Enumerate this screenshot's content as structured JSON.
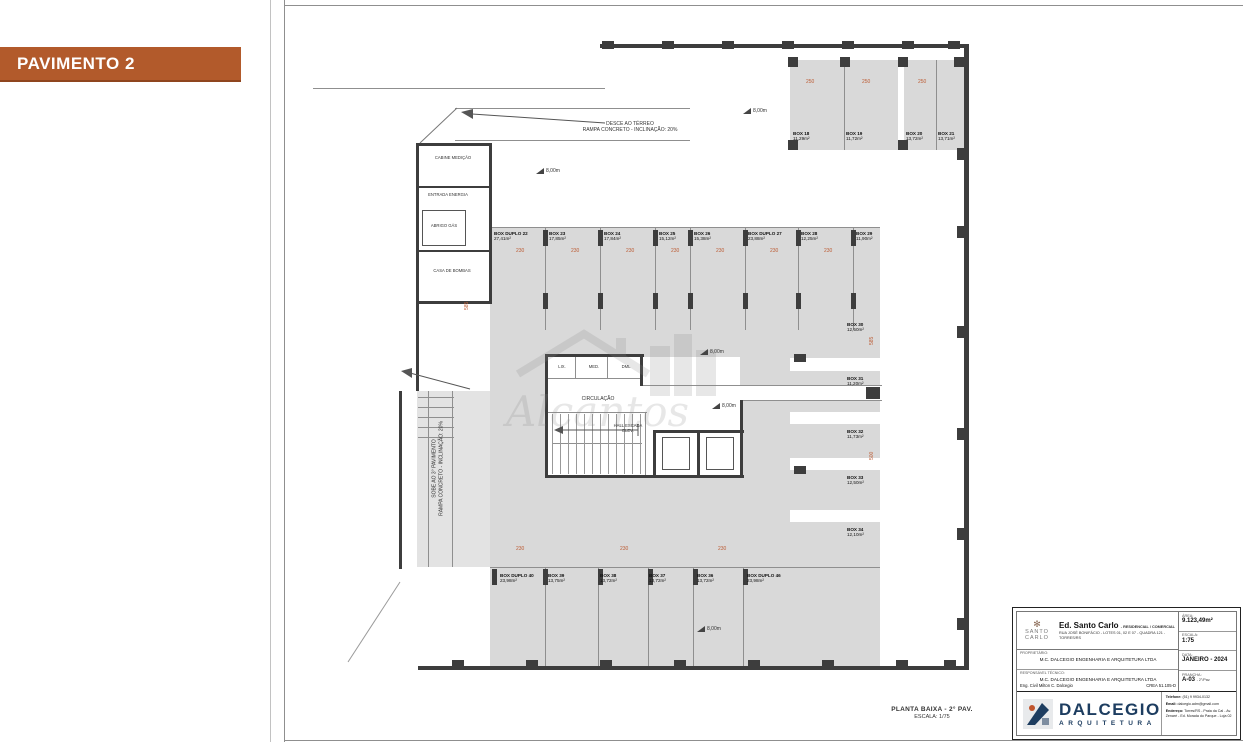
{
  "banner": {
    "label": "PAVIMENTO 2"
  },
  "plan": {
    "caption": {
      "line1": "PLANTA BAIXA - 2° PAV.",
      "line2": "ESCALA: 1/75"
    },
    "notes": {
      "ramp_down_1": "DESCE AO TÉRREO",
      "ramp_down_2": "RAMPA CONCRETO - INCLINAÇÃO: 20%",
      "ramp_up_1": "SOBE AO 3° PAVIMENTO",
      "ramp_up_2": "RAMPA CONCRETO - INCLINAÇÃO: 20%"
    },
    "core": {
      "lix": "LIX.",
      "med": "MED.",
      "dml": "DML",
      "circulation": "CIRCULAÇÃO",
      "hall_1": "HALL ESCADA",
      "hall_2": "ELEV."
    },
    "utility": [
      "CABINE MEDIÇÃO",
      "ENTRADA ENERGIA",
      "ABRIGO GÁS",
      "CASA DE BOMBAS"
    ],
    "level_marker": "8,00m",
    "boxes": [
      {
        "name": "BOX 18",
        "area": "11,29m²"
      },
      {
        "name": "BOX 19",
        "area": "11,72m²"
      },
      {
        "name": "BOX 20",
        "area": "13,72m²"
      },
      {
        "name": "BOX 21",
        "area": "13,71m²"
      },
      {
        "name": "BOX DUPLO 22",
        "area": "27,41m²"
      },
      {
        "name": "BOX 23",
        "area": "17,85m²"
      },
      {
        "name": "BOX 24",
        "area": "17,84m²"
      },
      {
        "name": "BOX 25",
        "area": "15,12m²"
      },
      {
        "name": "BOX 26",
        "area": "15,38m²"
      },
      {
        "name": "BOX DUPLO 27",
        "area": "23,88m²"
      },
      {
        "name": "BOX 28",
        "area": "12,25m²"
      },
      {
        "name": "BOX 29",
        "area": "11,90m²"
      },
      {
        "name": "BOX 30",
        "area": "12,50m²"
      },
      {
        "name": "BOX 31",
        "area": "11,20m²"
      },
      {
        "name": "BOX 32",
        "area": "11,73m²"
      },
      {
        "name": "BOX 33",
        "area": "12,50m²"
      },
      {
        "name": "BOX 34",
        "area": "12,10m²"
      },
      {
        "name": "BOX DUPLO 40",
        "area": "23,98m²"
      },
      {
        "name": "BOX 39",
        "area": "13,75m²"
      },
      {
        "name": "BOX 38",
        "area": "13,72m²"
      },
      {
        "name": "BOX 37",
        "area": "13,72m²"
      },
      {
        "name": "BOX 36",
        "area": "13,72m²"
      },
      {
        "name": "BOX DUPLO 46",
        "area": "23,98m²"
      }
    ],
    "dims": [
      "250",
      "250",
      "250",
      "230",
      "230",
      "230",
      "230",
      "230",
      "230",
      "230",
      "230",
      "230",
      "230",
      "585",
      "500",
      "585"
    ]
  },
  "watermark": {
    "text": "Alcantos"
  },
  "titleblock": {
    "client_logo": {
      "line1": "SANTO",
      "line2": "CARLO"
    },
    "project": {
      "title": "Ed. Santo Carlo",
      "subtitle": "- RESIDENCIAL / COMERCIAL",
      "address": "RUA JOSÉ BONIFÁCIO - LOTES 01, 02 E 07 - QUADRA 121 - TORRES/RS"
    },
    "fields": {
      "area_label": "ÁREA:",
      "area": "9.123,49m²",
      "escala_label": "ESCALA:",
      "escala": "1:75",
      "data_label": "DATA:",
      "data": "JANEIRO - 2024",
      "prancha_label": "PRANCHA:",
      "prancha": "A-03",
      "prancha_suffix": "- 2°/Pav."
    },
    "owner_label": "PROPRIETÁRIO:",
    "owner": "M.C. DALCEGIO ENGENHARIA E ARQUITETURA LTDA",
    "resp_label": "RESPONSÁVEL TÉCNICO:",
    "resp": "M.C. DALCEGIO ENGENHARIA E ARQUITETURA LTDA",
    "resp_eng": "Eng. Civil Milton C. Dalcegio",
    "resp_crea": "CREA 51.105-D",
    "firm": {
      "name": "DALCEGIO",
      "tagline": "ARQUITETURA"
    },
    "contact": {
      "phone_label": "Telefone:",
      "phone": "(51) 9 9934-0132",
      "email_label": "Email:",
      "email": "dalcegio.adm@gmail.com",
      "address_label": "Endereço:",
      "address": "Torres/RS - Praia da Cal - Av. Zenaré - Ed. Morada do Parque - Loja 02"
    }
  }
}
